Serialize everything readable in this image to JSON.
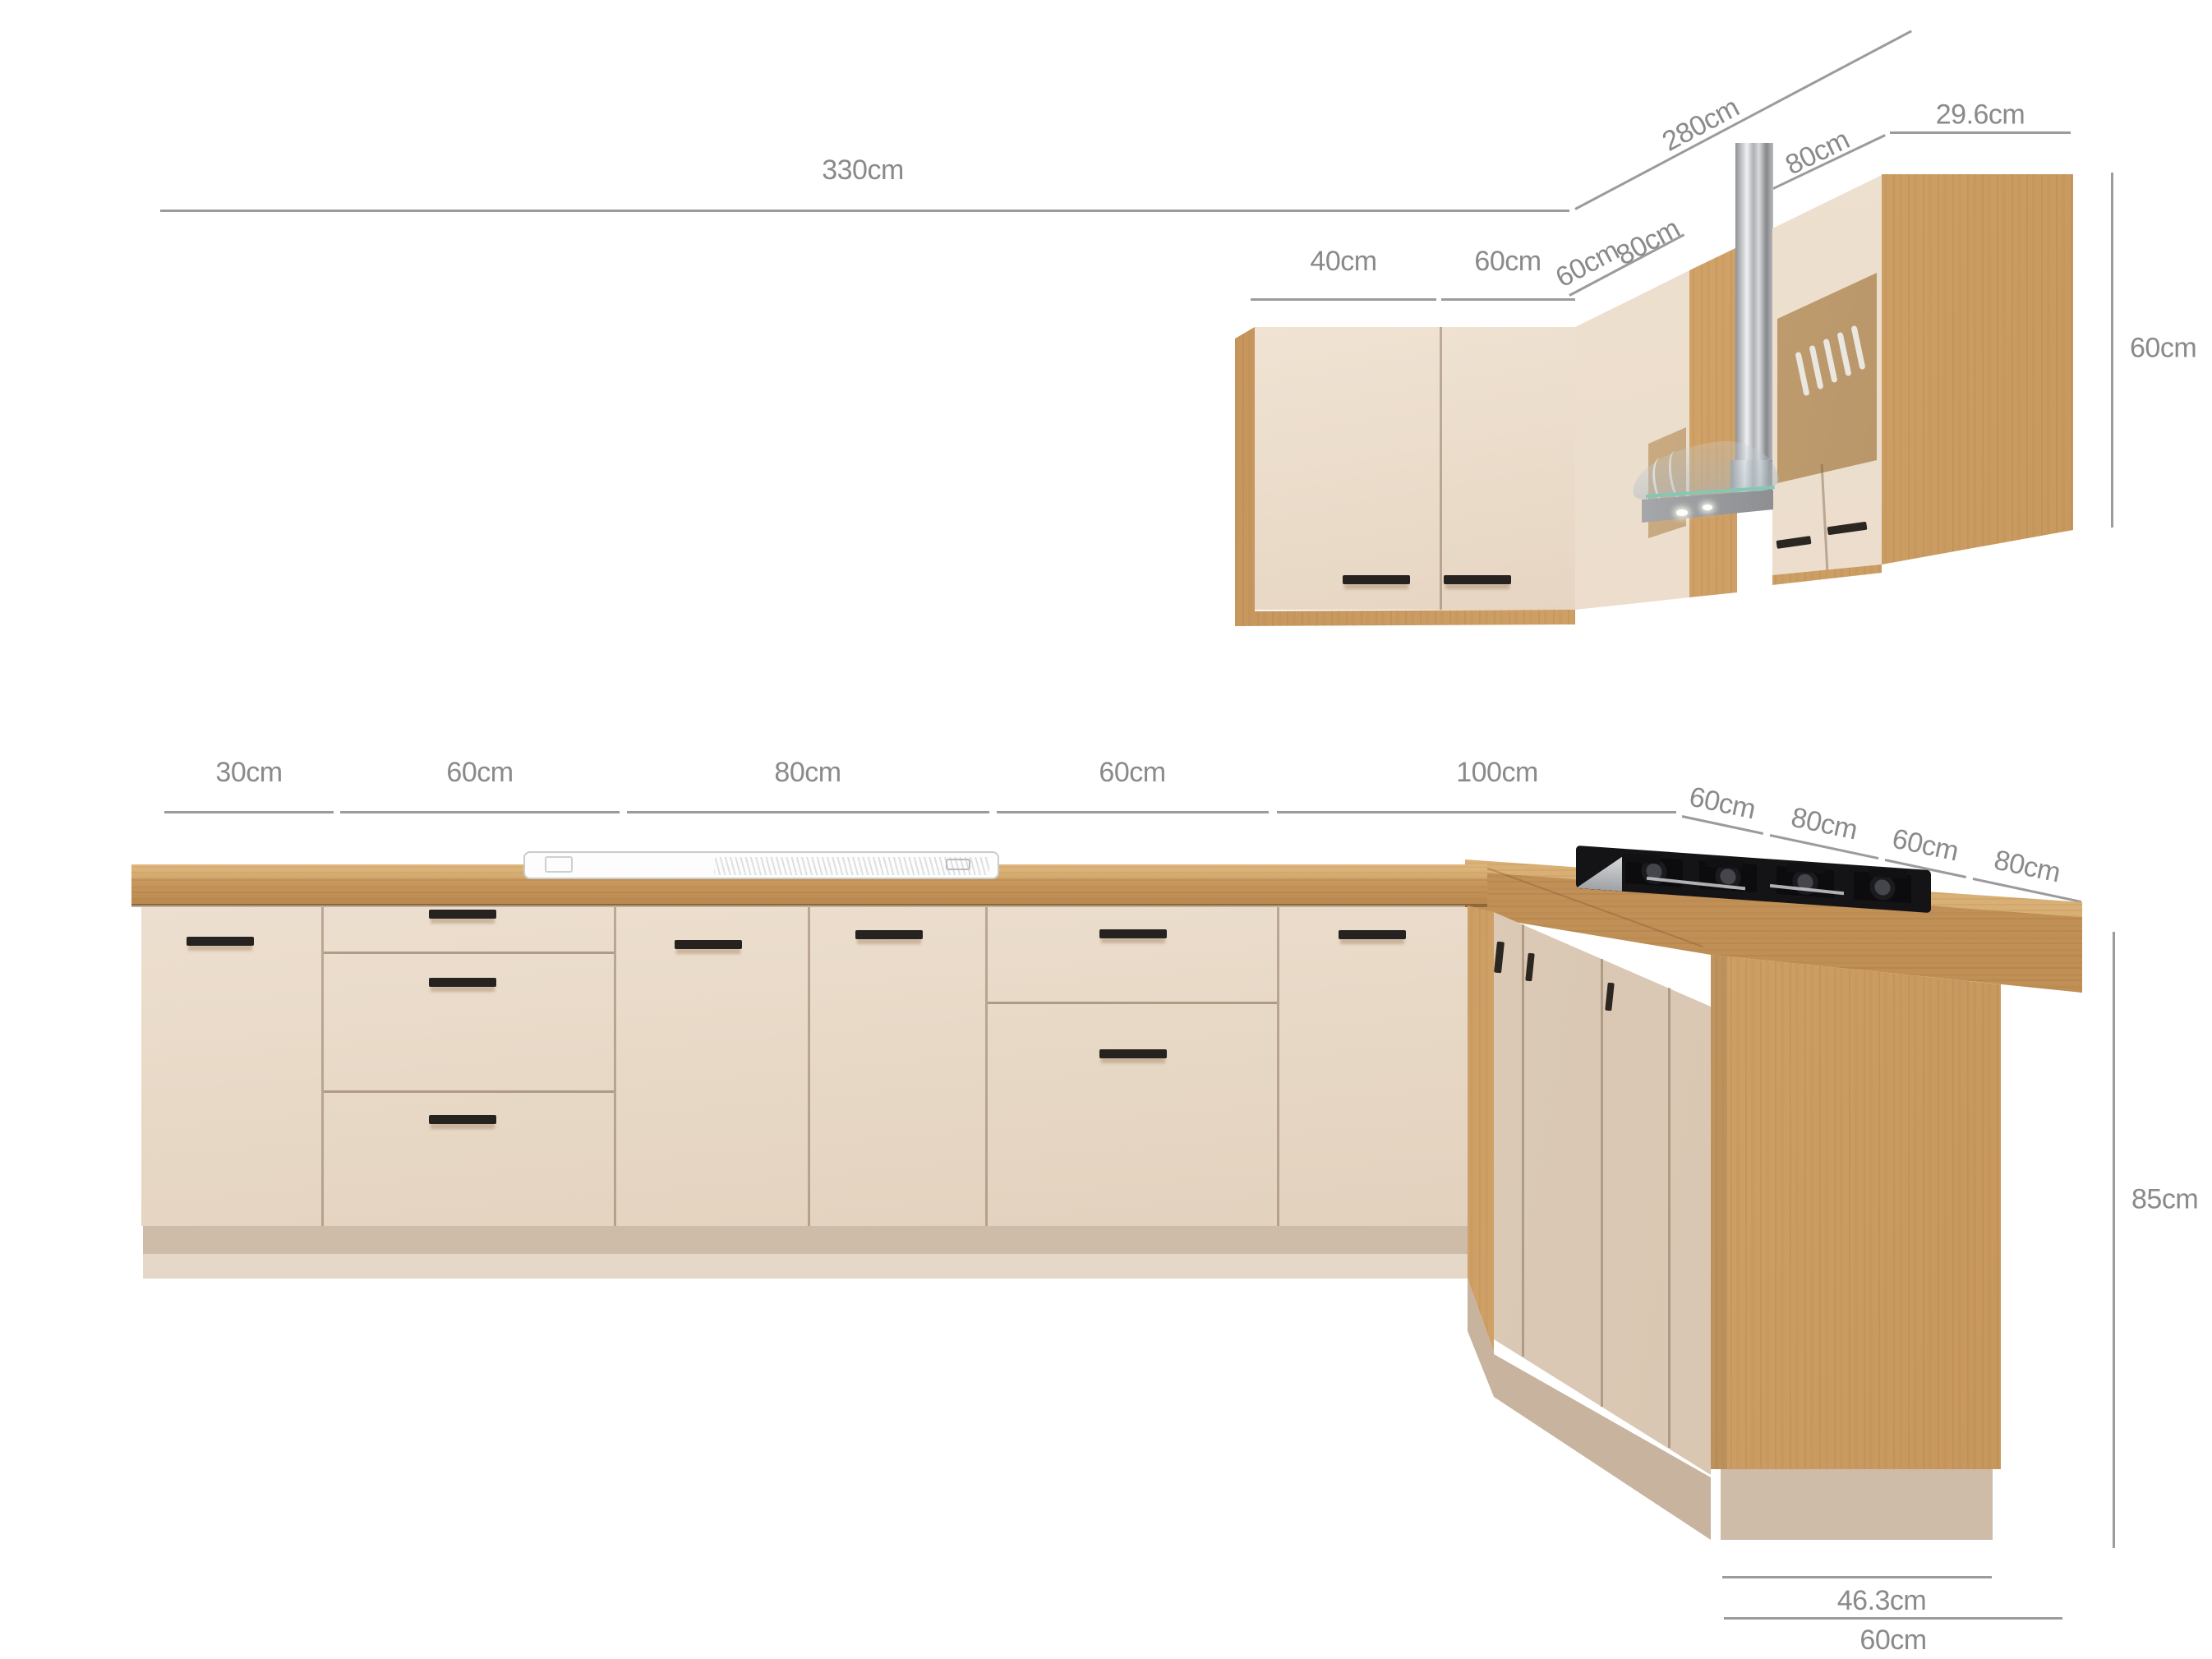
{
  "title": "L-shaped kitchen set dimension diagram",
  "units": "cm",
  "colors": {
    "background": "#ffffff",
    "dimension_line": "#9b9b9b",
    "dimension_text": "#8a8a8a",
    "cabinet_front_beige": "#e8d8c6",
    "oak_wood": "#c6975e",
    "plinth_taupe": "#cebba8",
    "hob_black": "#141417",
    "hood_steel": "#b9bbbe"
  },
  "dims": {
    "wall_total": "330cm",
    "wall_return": "280cm",
    "wall_cab1": "40cm",
    "wall_cab2": "60cm",
    "wall_corner_a": "60cm",
    "wall_corner_b": "80cm",
    "wall_hood": "80cm",
    "wall_end_depth": "29.6cm",
    "wall_height": "60cm",
    "base_u1": "30cm",
    "base_u2": "60cm",
    "base_u3": "80cm",
    "base_u4": "60cm",
    "base_u5": "100cm",
    "base_r1": "60cm",
    "base_r2": "80cm",
    "base_r3": "60cm",
    "base_r4": "80cm",
    "base_height": "85cm",
    "end_panel_depth": "46.3cm",
    "bar_depth": "60cm"
  }
}
